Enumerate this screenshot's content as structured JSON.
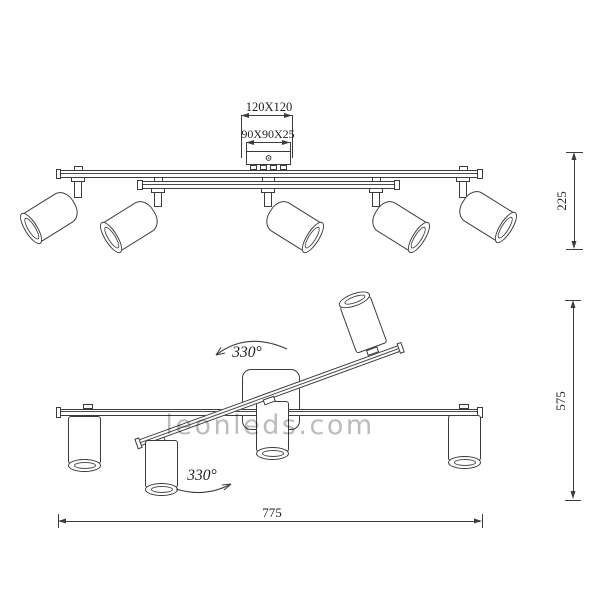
{
  "drawing": {
    "watermark": "leonleds.com",
    "top_view": {
      "canopy_plate_dim": "120X120",
      "junction_box_dim": "90X90X25",
      "height_dim": "225"
    },
    "bottom_view": {
      "rotation_upper": "330°",
      "rotation_lower": "330°",
      "height_dim": "575",
      "length_dim": "775"
    },
    "colors": {
      "line": "#3c3c3c",
      "dimension_text": "#1f1f1f",
      "watermark": "#bcbcbc"
    }
  }
}
